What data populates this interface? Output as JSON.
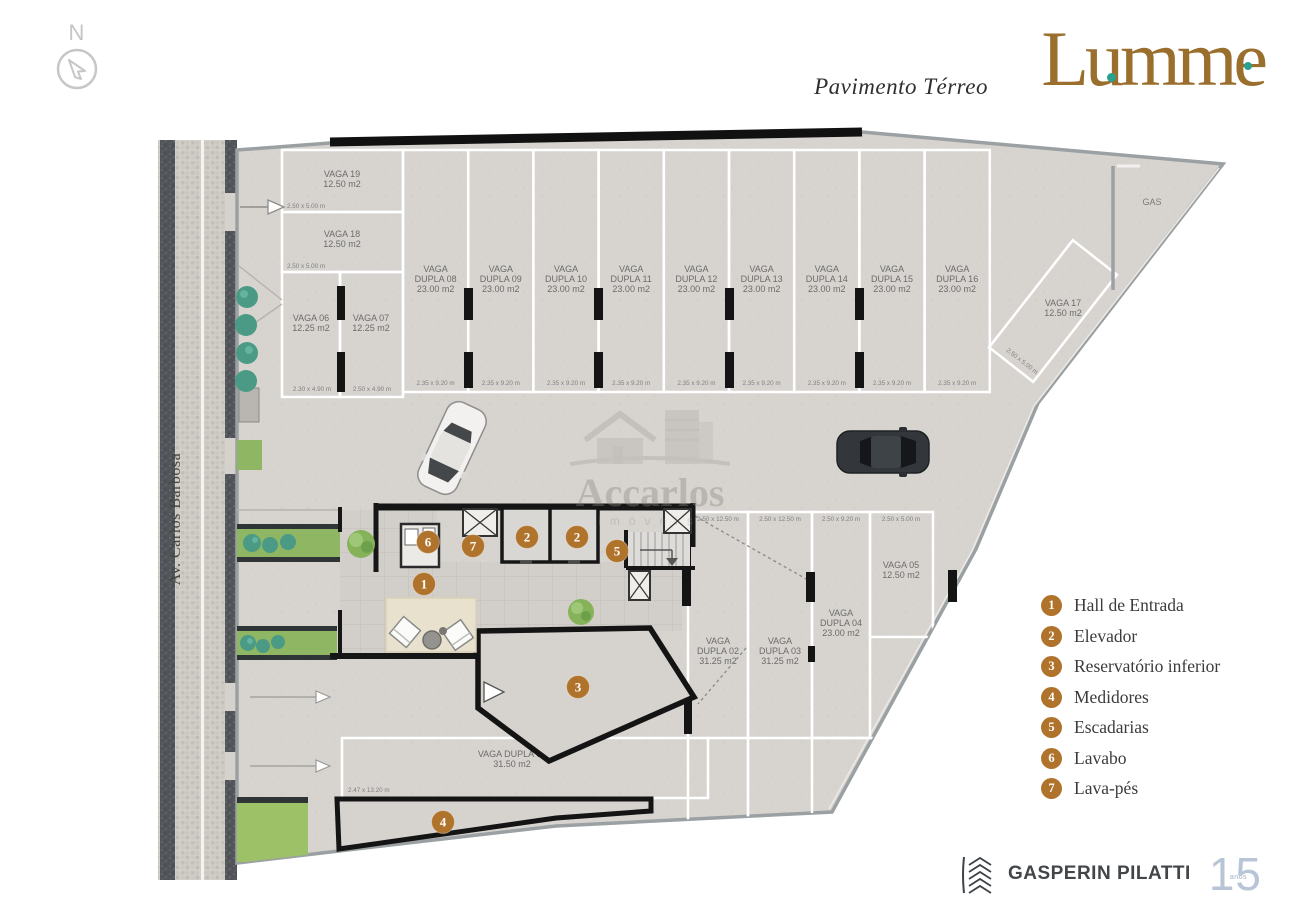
{
  "header": {
    "floor_label": "Pavimento Térreo",
    "brand": "Lumme"
  },
  "compass": {
    "north": "N"
  },
  "street": {
    "name": "Av. Carlos Barbosa"
  },
  "watermark": {
    "brand": "Accarlos",
    "sub": "imóveis"
  },
  "plan": {
    "gas_label": "GAS",
    "spaces": [
      {
        "id": "v19",
        "lines": [
          "VAGA 19",
          "12.50 m2"
        ],
        "dims": "2.50 x 5.00 m"
      },
      {
        "id": "v18",
        "lines": [
          "VAGA 18",
          "12.50 m2"
        ],
        "dims": "2.50 x 5.00 m"
      },
      {
        "id": "v06",
        "lines": [
          "VAGA 06",
          "12.25 m2"
        ],
        "dims": "2.30 x 4.90 m"
      },
      {
        "id": "v07",
        "lines": [
          "VAGA 07",
          "12.25 m2"
        ],
        "dims": "2.50 x 4.90 m"
      },
      {
        "id": "d08",
        "lines": [
          "VAGA",
          "DUPLA 08",
          "23.00 m2"
        ],
        "dims": "2.35 x 9.20 m"
      },
      {
        "id": "d09",
        "lines": [
          "VAGA",
          "DUPLA 09",
          "23.00 m2"
        ],
        "dims": "2.35 x 9.20 m"
      },
      {
        "id": "d10",
        "lines": [
          "VAGA",
          "DUPLA 10",
          "23.00 m2"
        ],
        "dims": "2.35 x 9.20 m"
      },
      {
        "id": "d11",
        "lines": [
          "VAGA",
          "DUPLA 11",
          "23.00 m2"
        ],
        "dims": "2.35 x 9.20 m"
      },
      {
        "id": "d12",
        "lines": [
          "VAGA",
          "DUPLA 12",
          "23.00 m2"
        ],
        "dims": "2.35 x 9.20 m"
      },
      {
        "id": "d13",
        "lines": [
          "VAGA",
          "DUPLA 13",
          "23.00 m2"
        ],
        "dims": "2.35 x 9.20 m"
      },
      {
        "id": "d14",
        "lines": [
          "VAGA",
          "DUPLA 14",
          "23.00 m2"
        ],
        "dims": "2.35 x 9.20 m"
      },
      {
        "id": "d15",
        "lines": [
          "VAGA",
          "DUPLA 15",
          "23.00 m2"
        ],
        "dims": "2.35 x 9.20 m"
      },
      {
        "id": "d16",
        "lines": [
          "VAGA",
          "DUPLA 16",
          "23.00 m2"
        ],
        "dims": "2.35 x 9.20 m"
      },
      {
        "id": "v17",
        "lines": [
          "VAGA 17",
          "12.50 m2"
        ],
        "dims": "2.50 x 5.00 m"
      },
      {
        "id": "d02",
        "lines": [
          "VAGA",
          "DUPLA 02",
          "31.25 m2"
        ],
        "dims": "2.50 x 12.50 m"
      },
      {
        "id": "d03",
        "lines": [
          "VAGA",
          "DUPLA 03",
          "31.25 m2"
        ],
        "dims": "2.50 x 12.50 m"
      },
      {
        "id": "d04",
        "lines": [
          "VAGA",
          "DUPLA 04",
          "23.00 m2"
        ],
        "dims": "2.50 x 9.20 m"
      },
      {
        "id": "v05",
        "lines": [
          "VAGA 05",
          "12.50 m2"
        ],
        "dims": "2.50 x 5.00 m"
      },
      {
        "id": "d01",
        "lines": [
          "VAGA DUPLA 01",
          "31.50 m2"
        ],
        "dims": "2.47 x 13.20 m"
      }
    ],
    "badge_markers": [
      {
        "n": "1"
      },
      {
        "n": "2"
      },
      {
        "n": "2"
      },
      {
        "n": "3"
      },
      {
        "n": "4"
      },
      {
        "n": "5"
      },
      {
        "n": "6"
      },
      {
        "n": "7"
      }
    ]
  },
  "legend": {
    "items": [
      {
        "number": "1",
        "label": "Hall de Entrada"
      },
      {
        "number": "2",
        "label": "Elevador"
      },
      {
        "number": "3",
        "label": "Reservatório inferior"
      },
      {
        "number": "4",
        "label": "Medidores"
      },
      {
        "number": "5",
        "label": "Escadarias"
      },
      {
        "number": "6",
        "label": "Lavabo"
      },
      {
        "number": "7",
        "label": "Lava-pés"
      }
    ]
  },
  "footer": {
    "company": "GASPERIN PILATTI",
    "years": "15",
    "years_label": "anos"
  },
  "colors": {
    "badge": "#b0732c",
    "brand_gold": "#9a6e2d",
    "brand_teal": "#2aa18f",
    "wall": "#161616"
  }
}
